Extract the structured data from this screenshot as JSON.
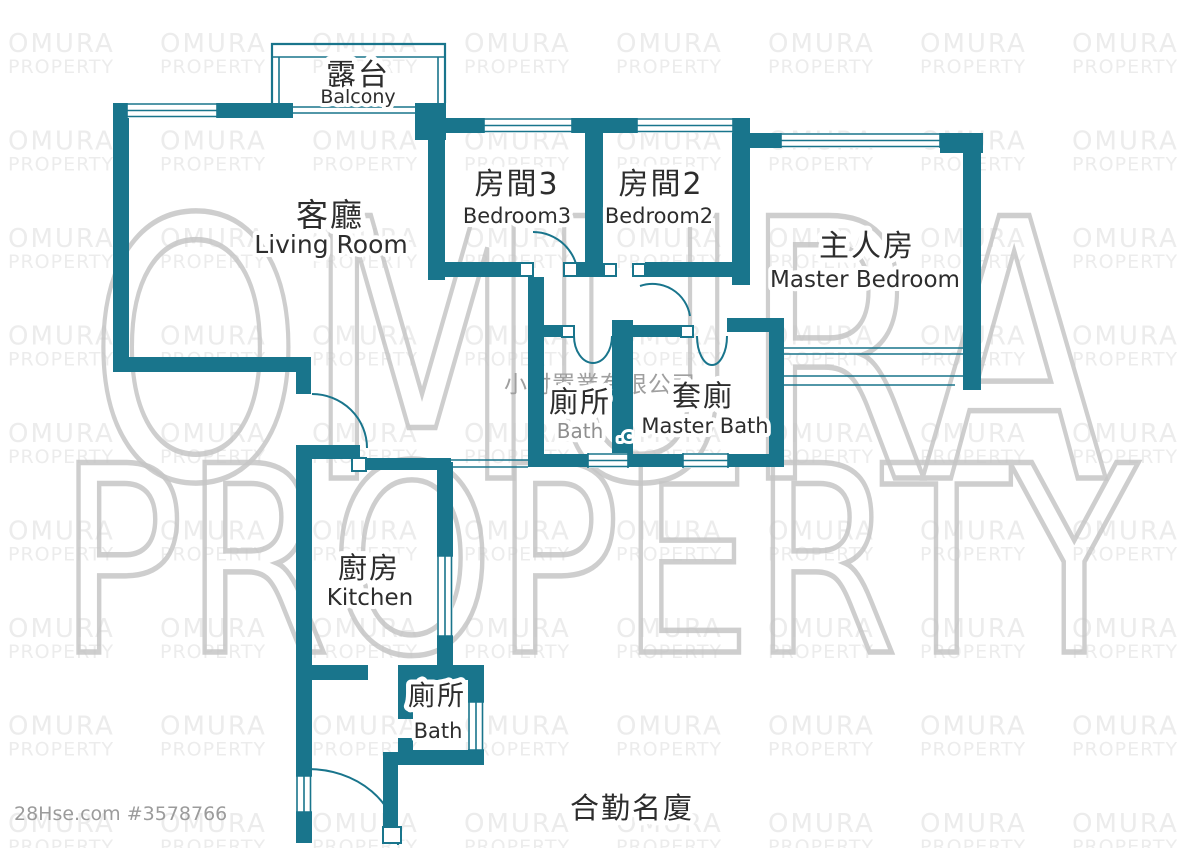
{
  "colors": {
    "wall": "#19758c",
    "label_dark": "#2d2d2d",
    "label_muted": "#8f8f8f",
    "ref_gray": "#9b9b9b",
    "watermark_tile": "#ececec",
    "watermark_big": "#c6c6c6",
    "watermark_company": "#9f9f9f"
  },
  "watermarks": {
    "tile_line1": "OMURA",
    "tile_line2": "PROPERTY",
    "big_line1": "OMURA",
    "big_line2": "PROPERTY",
    "company": "小村置業有限公司",
    "fragment": ".c"
  },
  "rooms": {
    "balcony": {
      "cn": "露台",
      "en": "Balcony"
    },
    "living_room": {
      "cn": "客廳",
      "en": "Living Room"
    },
    "bedroom3": {
      "cn": "房間3",
      "en": "Bedroom3"
    },
    "bedroom2": {
      "cn": "房間2",
      "en": "Bedroom2"
    },
    "master_bedroom": {
      "cn": "主人房",
      "en": "Master Bedroom"
    },
    "bath": {
      "cn": "廁所",
      "en": "Bath"
    },
    "master_bath": {
      "cn": "套廁",
      "en": "Master Bath"
    },
    "kitchen": {
      "cn": "廚房",
      "en": "Kitchen"
    },
    "bath_lower": {
      "cn": "廁所",
      "en": "Bath"
    }
  },
  "footer": {
    "listing_ref": "28Hse.com #3578766",
    "building_name": "合勤名廈"
  }
}
